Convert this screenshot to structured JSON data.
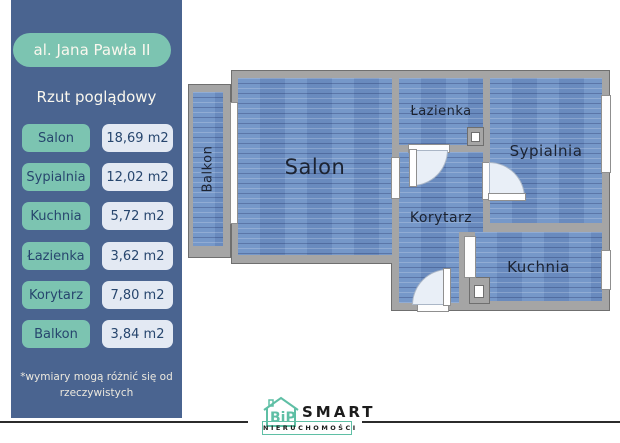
{
  "sidebar": {
    "address": "al. Jana Pawła II",
    "subtitle": "Rzut poglądowy",
    "rows": [
      {
        "label": "Salon",
        "value": "18,69 m2"
      },
      {
        "label": "Sypialnia",
        "value": "12,02 m2"
      },
      {
        "label": "Kuchnia",
        "value": "5,72 m2"
      },
      {
        "label": "Łazienka",
        "value": "3,62 m2"
      },
      {
        "label": "Korytarz",
        "value": "7,80 m2"
      },
      {
        "label": "Balkon",
        "value": "3,84 m2"
      }
    ],
    "footnote_line1": "*wymiary mogą różnić się od",
    "footnote_line2": "rzeczywistych"
  },
  "floorplan": {
    "rooms": [
      {
        "name": "salon",
        "label": "Salon"
      },
      {
        "name": "lazienka",
        "label": "Łazienka"
      },
      {
        "name": "sypialnia",
        "label": "Sypialnia"
      },
      {
        "name": "korytarz",
        "label": "Korytarz"
      },
      {
        "name": "kuchnia",
        "label": "Kuchnia"
      },
      {
        "name": "balkon",
        "label": "Balkon"
      }
    ]
  },
  "footer": {
    "logo_monogram": "BiP",
    "logo_name": "SMART",
    "logo_subtitle": "NIERUCHOMOŚCI"
  },
  "colors": {
    "sidebar_bg": "#4a6490",
    "accent_teal": "#7cc4b1",
    "value_pill_bg": "#e3e9f3",
    "floor_blue": "#6f92c6",
    "wall_gray": "#a5a5a5",
    "footer_line": "#2b2b2b",
    "logo_teal": "#5fbfa5"
  }
}
